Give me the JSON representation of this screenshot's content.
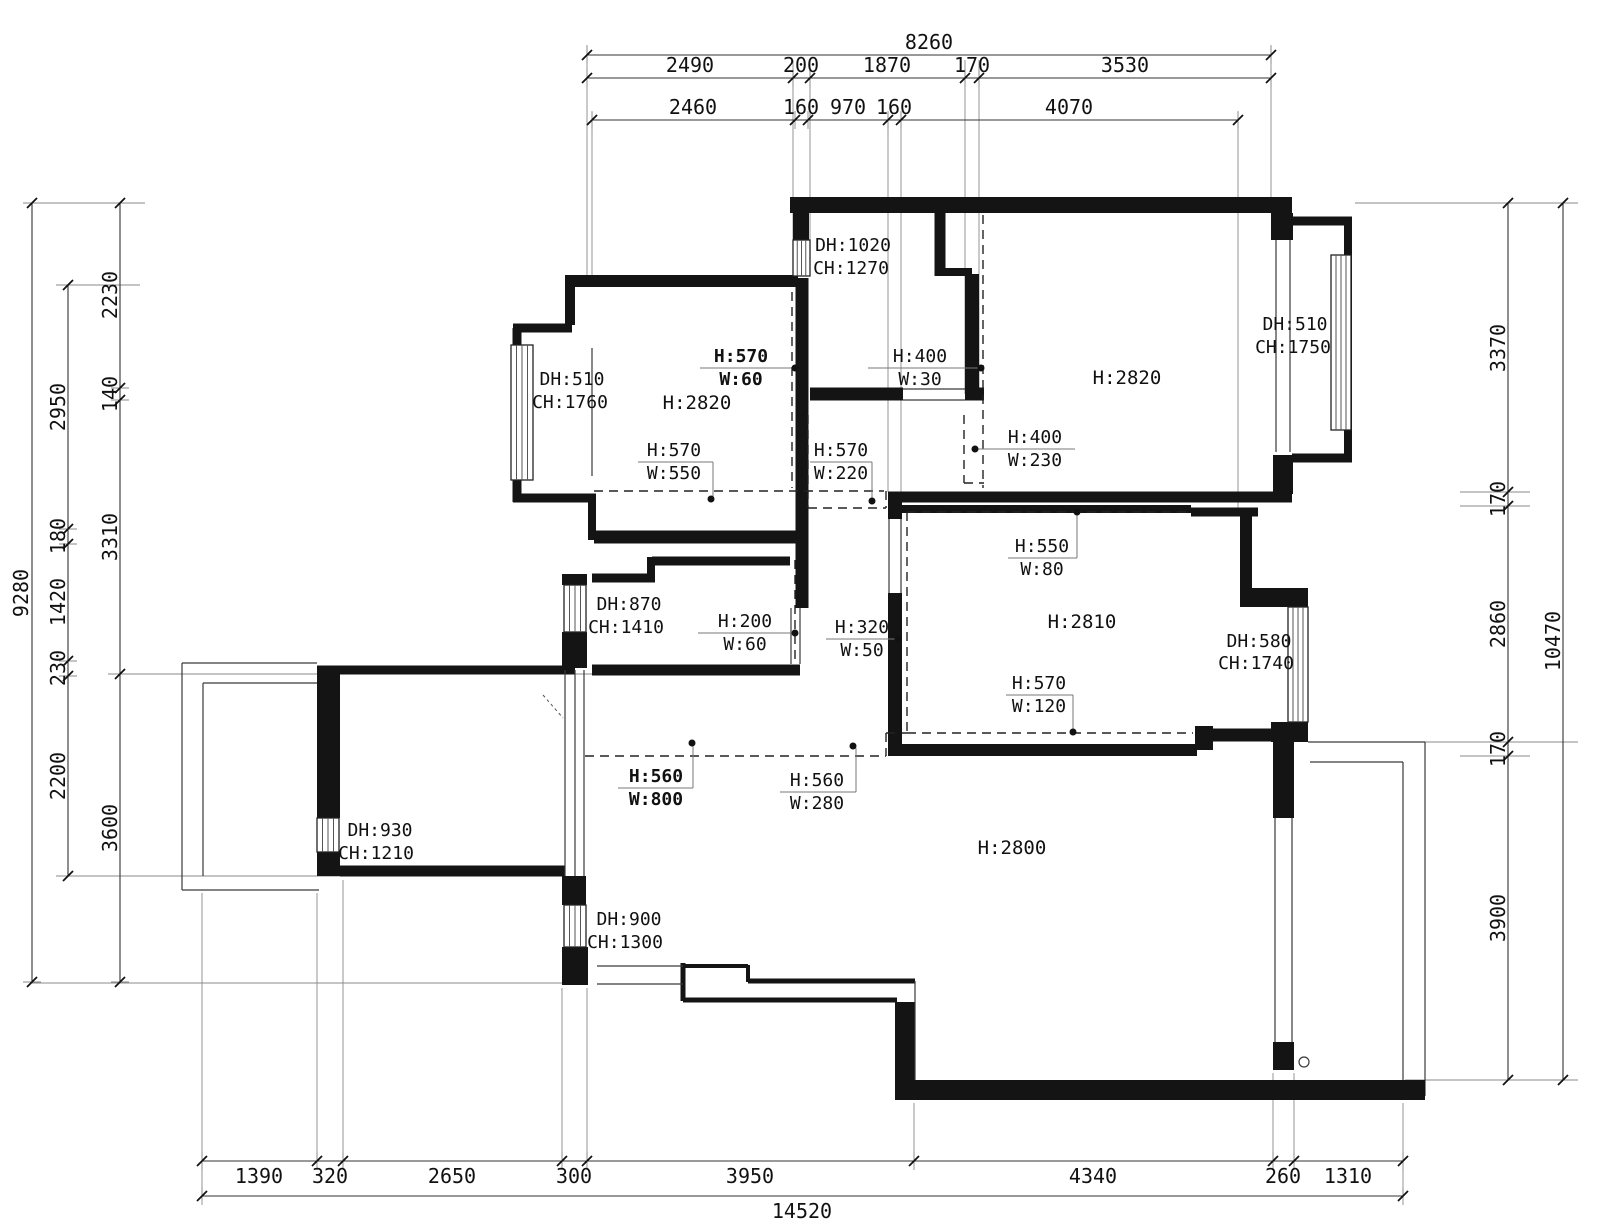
{
  "drawing": {
    "dims_top": {
      "total": "8260",
      "row2": [
        "2490",
        "200",
        "1870",
        "170",
        "3530"
      ],
      "row3": [
        "2460",
        "160",
        "970",
        "160",
        "4070"
      ]
    },
    "dims_left": {
      "total": "9280",
      "chain_mid": [
        "2950",
        "180",
        "1420",
        "230",
        "2200"
      ],
      "chain_inner": [
        "2230",
        "140",
        "3310",
        "3600"
      ]
    },
    "dims_right": {
      "total": "10470",
      "chain": [
        "3370",
        "170",
        "2860",
        "170",
        "3900"
      ]
    },
    "dims_bottom": {
      "segments": [
        "1390",
        "320",
        "2650",
        "300",
        "3950",
        "4340",
        "260",
        "1310"
      ],
      "total": "14520"
    },
    "rooms": [
      {
        "height": "H:2820"
      },
      {
        "height": "H:2820"
      },
      {
        "height": "H:2810"
      },
      {
        "height": "H:2800"
      }
    ],
    "windows": [
      {
        "dh": "DH:510",
        "ch": "CH:1760"
      },
      {
        "dh": "DH:1020",
        "ch": "CH:1270"
      },
      {
        "dh": "DH:510",
        "ch": "CH:1750"
      },
      {
        "dh": "DH:870",
        "ch": "CH:1410"
      },
      {
        "dh": "DH:580",
        "ch": "CH:1740"
      },
      {
        "dh": "DH:930",
        "ch": "CH:1210"
      },
      {
        "dh": "DH:900",
        "ch": "CH:1300"
      }
    ],
    "features": [
      {
        "h": "H:570",
        "w": "W:60"
      },
      {
        "h": "H:400",
        "w": "W:30"
      },
      {
        "h": "H:400",
        "w": "W:230"
      },
      {
        "h": "H:570",
        "w": "W:550"
      },
      {
        "h": "H:570",
        "w": "W:220"
      },
      {
        "h": "H:550",
        "w": "W:80"
      },
      {
        "h": "H:200",
        "w": "W:60"
      },
      {
        "h": "H:320",
        "w": "W:50"
      },
      {
        "h": "H:570",
        "w": "W:120"
      },
      {
        "h": "H:560",
        "w": "W:800"
      },
      {
        "h": "H:560",
        "w": "W:280"
      }
    ]
  }
}
